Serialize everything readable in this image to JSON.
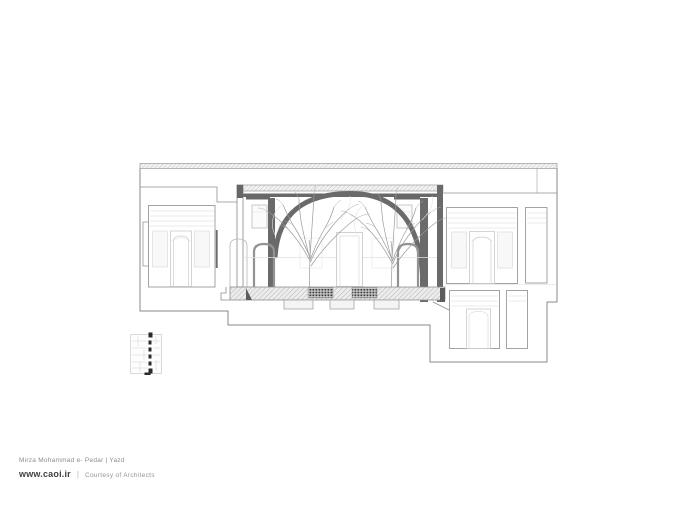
{
  "footer": {
    "project": "Mirza Mohammad e- Pedar | Yazd",
    "website": "www.caoi.ir",
    "separator": "|",
    "credit": "Courtesy of Architects"
  },
  "drawing": {
    "palette": {
      "paper": "#ffffff",
      "outline": "#8a8a8a",
      "light_detail": "#d5d5d5",
      "cut_poche": "#6a6a6a",
      "grille_dark": "#3d3d3d",
      "hatch": "#b5b5b5",
      "keyplan_marker": "#2a2a2a"
    }
  }
}
